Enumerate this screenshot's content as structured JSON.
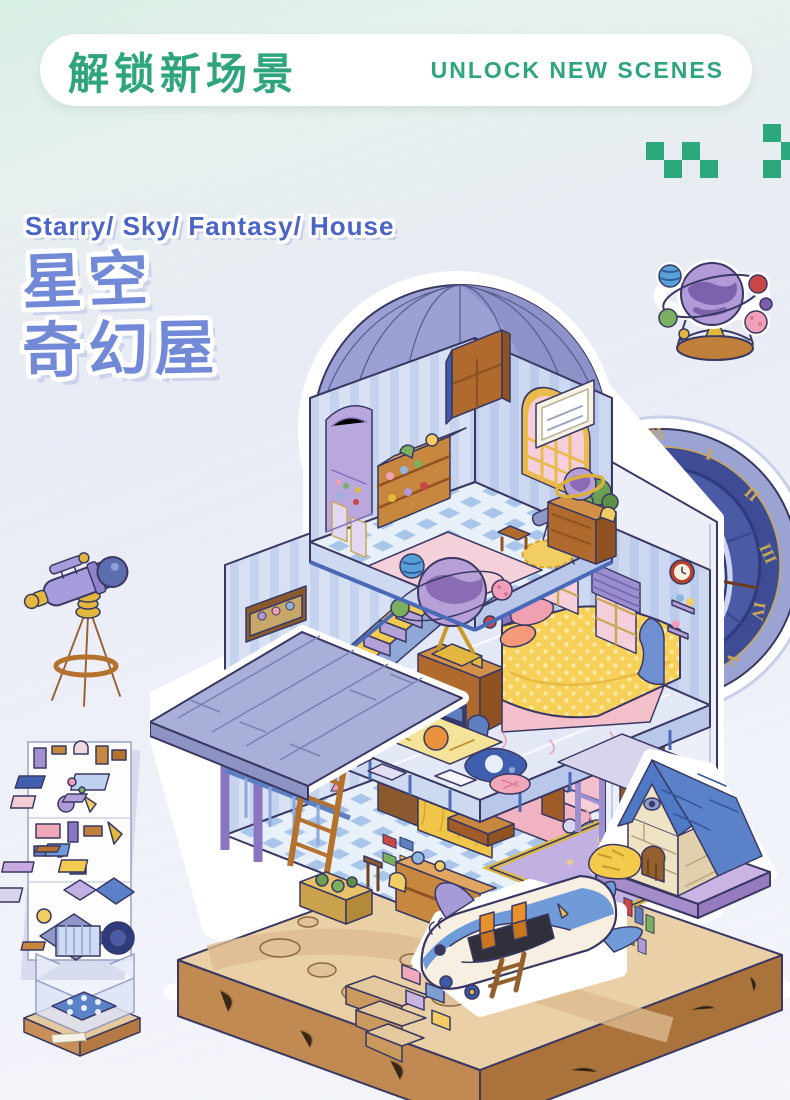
{
  "page": {
    "background_top": "#ddefe6",
    "background_bottom": "#f3f4fa"
  },
  "header": {
    "title_cn": "解锁新场景",
    "title_en": "UNLOCK NEW SCENES",
    "accent_color": "#2ea57c"
  },
  "decor": {
    "pixel_accent_color": "#2ba87c"
  },
  "hero": {
    "subtitle_en": "Starry/ Sky/ Fantasy/ House",
    "title_cn_line1": "星空",
    "title_cn_line2": "奇幻屋",
    "subtitle_color": "#4b64c6",
    "title_color": "#7289d8"
  },
  "clock": {
    "numerals": [
      "XI",
      "XII",
      "I",
      "II",
      "III",
      "IV",
      "V",
      "VI",
      "VII"
    ]
  },
  "scene": {
    "name": "starry-sky-fantasy-house-playset",
    "elements": [
      "observatory-dome",
      "astronomy-attic",
      "celestial-globe",
      "grand-clock",
      "staircase",
      "study-desk",
      "bed",
      "living-room-sofa",
      "tv",
      "bookshelf",
      "wooden-ladder",
      "dog-house",
      "hay-pile",
      "whale-plane",
      "dirt-base",
      "stone-steps",
      "sticker-sheet",
      "empty-room-base",
      "telescope",
      "planet-ornament"
    ]
  }
}
